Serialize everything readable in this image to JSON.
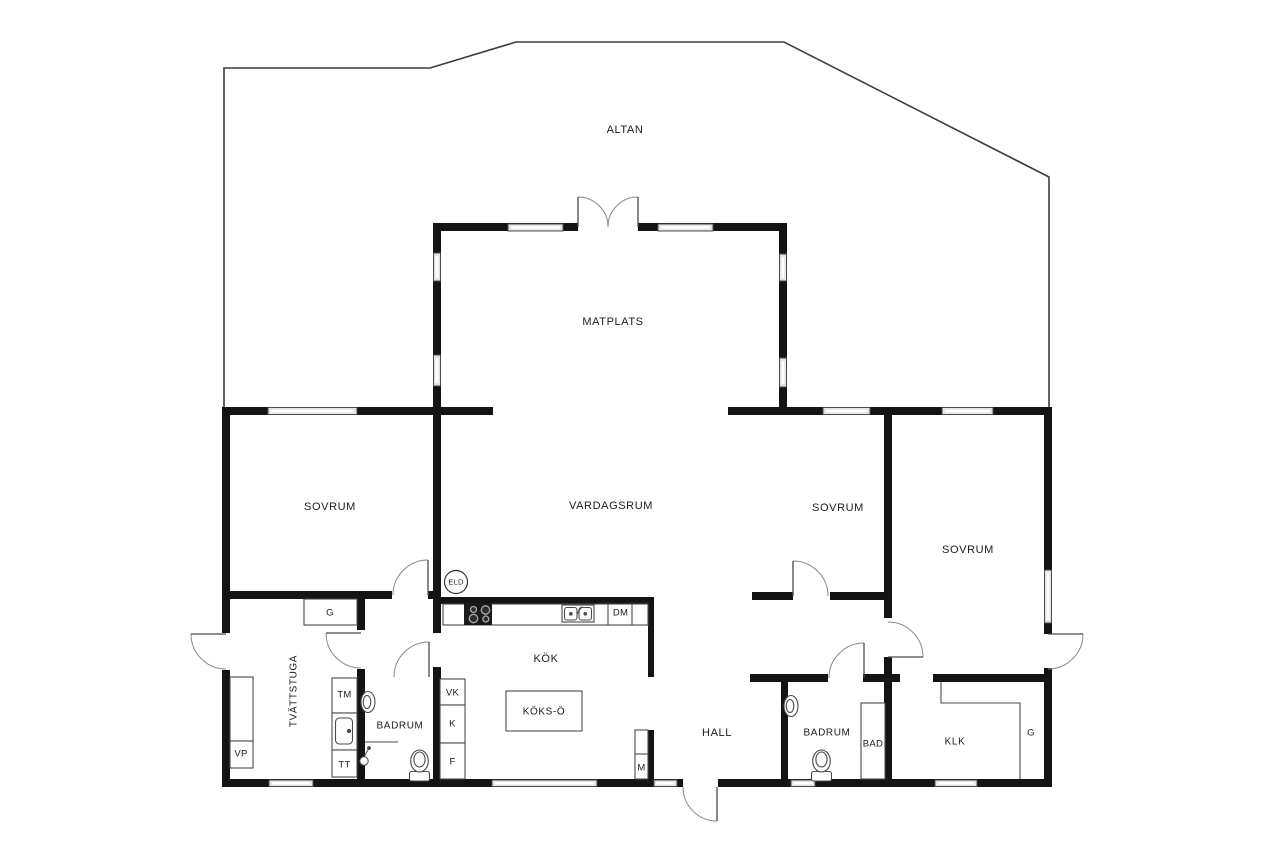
{
  "colors": {
    "wall": "#141414",
    "fixture_line": "#4a4a4a",
    "door_arc": "#8a8a8a",
    "window_fill": "#e4e4e4",
    "text": "#1b1b1b"
  },
  "rooms": {
    "altan": "ALTAN",
    "matplats": "MATPLATS",
    "vardagsrum": "VARDAGSRUM",
    "sovrum_left": "SOVRUM",
    "sovrum_mid": "SOVRUM",
    "sovrum_right": "SOVRUM",
    "kok": "KÖK",
    "koks_o": "KÖKS-Ö",
    "hall": "HALL",
    "badrum_left": "BADRUM",
    "badrum_right": "BADRUM",
    "bad": "BAD",
    "tvattstuga": "TVÄTTSTUGA",
    "klk": "KLK"
  },
  "fixtures": {
    "garderob_left": "G",
    "garderob_right": "G",
    "varmepump": "VP",
    "tvattmaskin": "TM",
    "torktumlare": "TT",
    "vinkyl": "VK",
    "kyl": "K",
    "frys": "F",
    "diskmaskin": "DM",
    "matarskap": "M",
    "eldstad": "ELD"
  }
}
